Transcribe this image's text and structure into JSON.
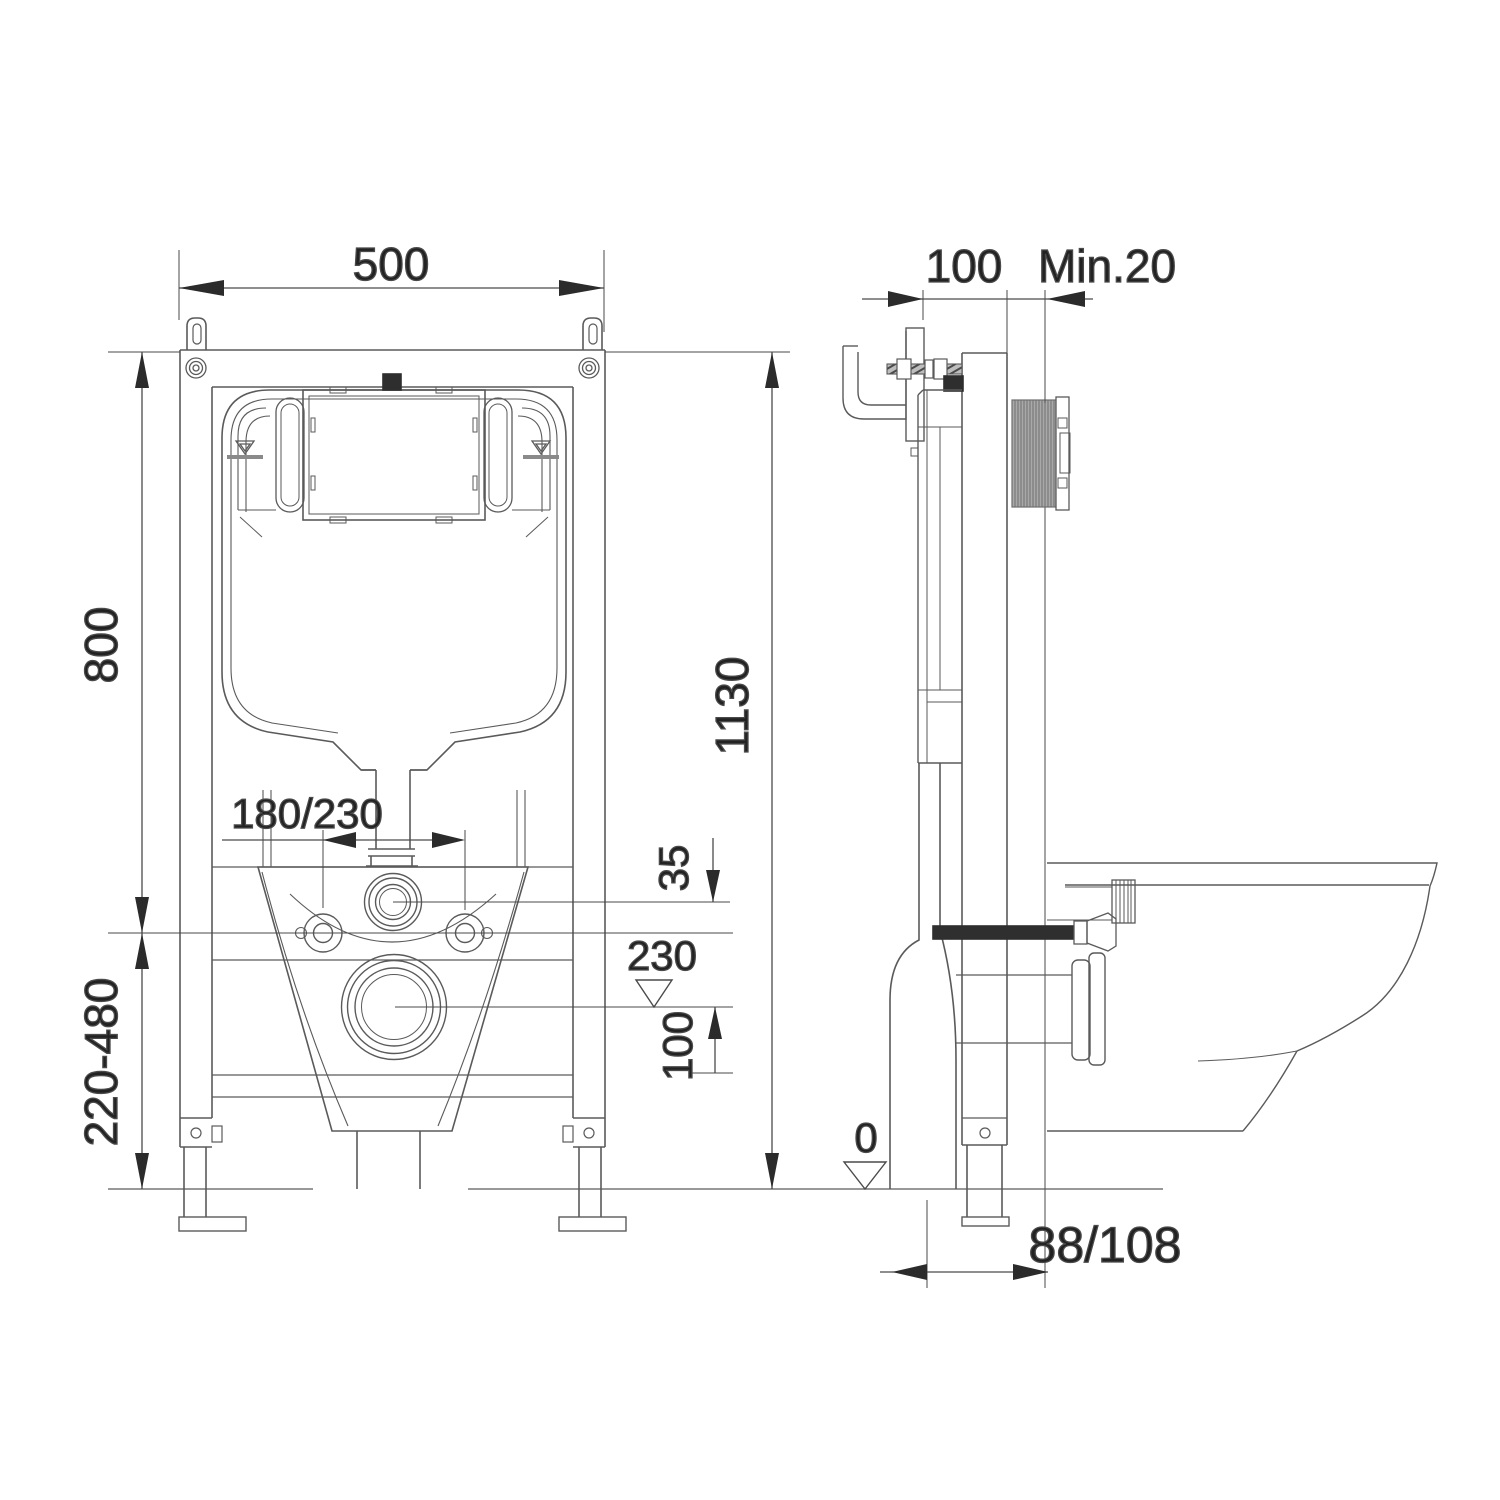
{
  "drawing": {
    "kind": "installation-drawing",
    "subject": "concealed cistern wall frame with wall-hung toilet",
    "background": "#ffffff",
    "line_color": "#5a5a5a",
    "dim_color": "#2b2b2b",
    "text_color": "#222222",
    "ribbed_fill": "#a9a9a9",
    "black_part": "#2e2e2e"
  },
  "views": {
    "front": {
      "name": "front elevation"
    },
    "side": {
      "name": "side section"
    }
  },
  "dimensions": {
    "frame_width": "500",
    "frame_depth": "100",
    "min_wall_clearance": "Min.20",
    "cistern_height": "800",
    "frame_total_height": "1130",
    "flush_bend_offset": "180/230",
    "inlet_axis_offset": "35",
    "outlet_axis_level": "230",
    "outlet_drop": "100",
    "leg_adjustment_range": "220-480",
    "floor_level": "0",
    "outlet_wall_offset": "88/108"
  },
  "icons": {
    "water_level_marker": "triangle-over-bar",
    "datum_level_marker": "open-triangle"
  }
}
